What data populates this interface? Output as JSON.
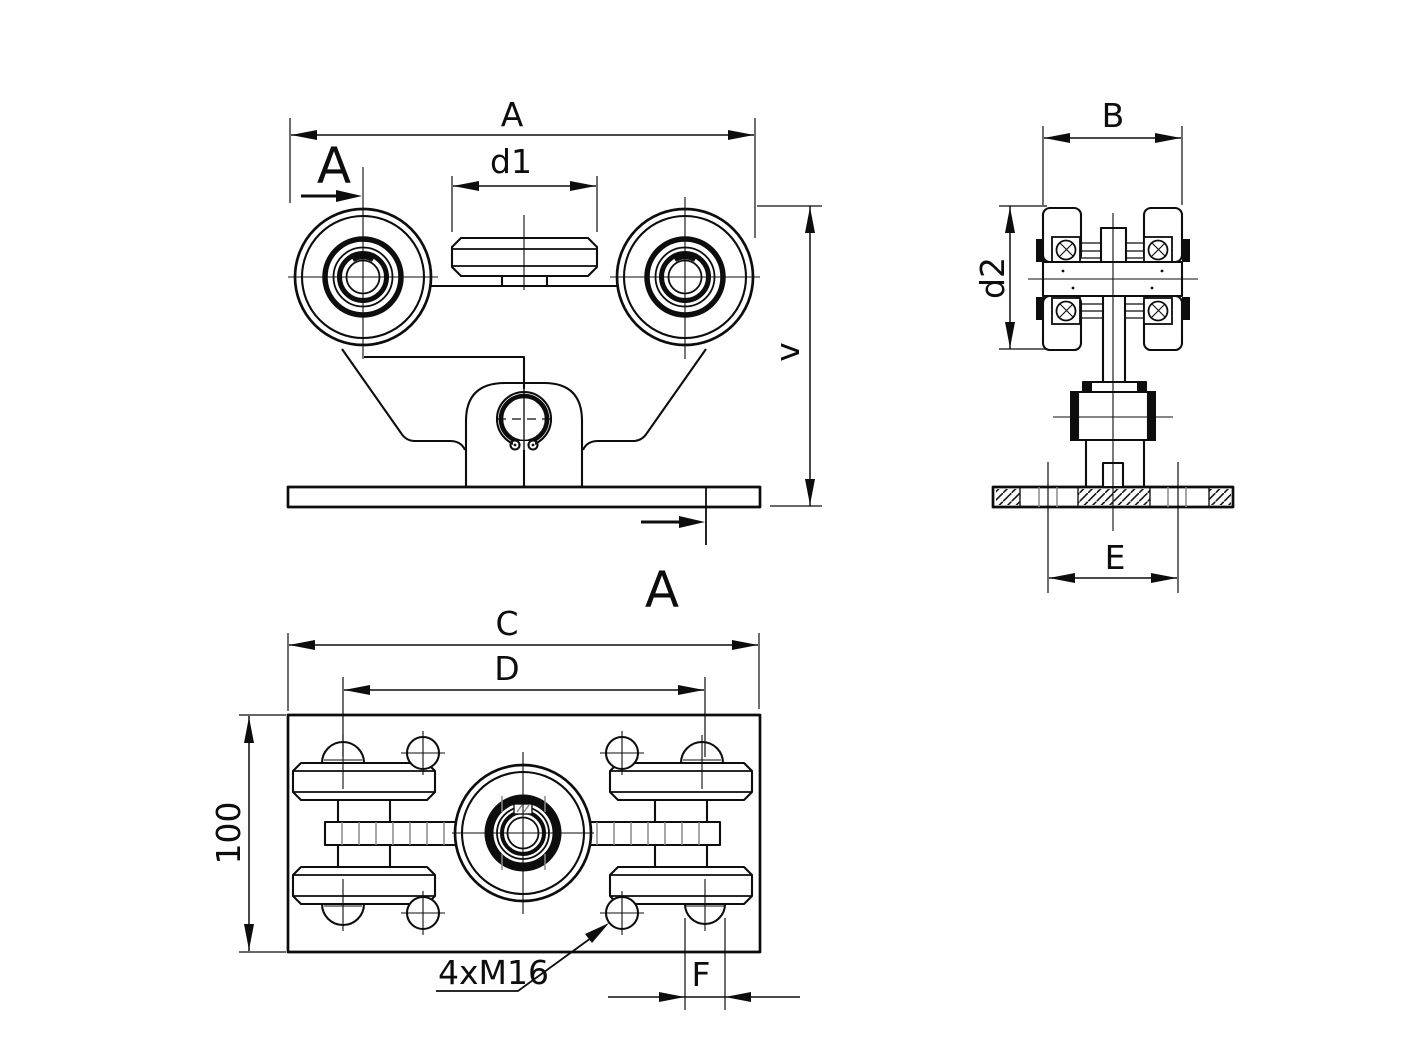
{
  "drawing_title": "Sliding gate roller carriage - three view technical drawing",
  "colors": {
    "background": "#ffffff",
    "line": "#0d0d0d",
    "secondary_line": "#8a8a8a"
  },
  "front_view": {
    "dim_overall_width": "A",
    "dim_spacer_width": "d1",
    "dim_height": "v",
    "section_letter_top": "A",
    "section_letter_bottom": "A"
  },
  "section_view": {
    "dim_wheel_width": "B",
    "dim_wheel_diameter": "d2",
    "dim_hole_span": "E"
  },
  "plan_view": {
    "dim_plate_length": "C",
    "dim_hole_span_long": "D",
    "dim_plate_width": "100",
    "dim_hole_pitch": "F",
    "thread_callout": "4xM16"
  }
}
